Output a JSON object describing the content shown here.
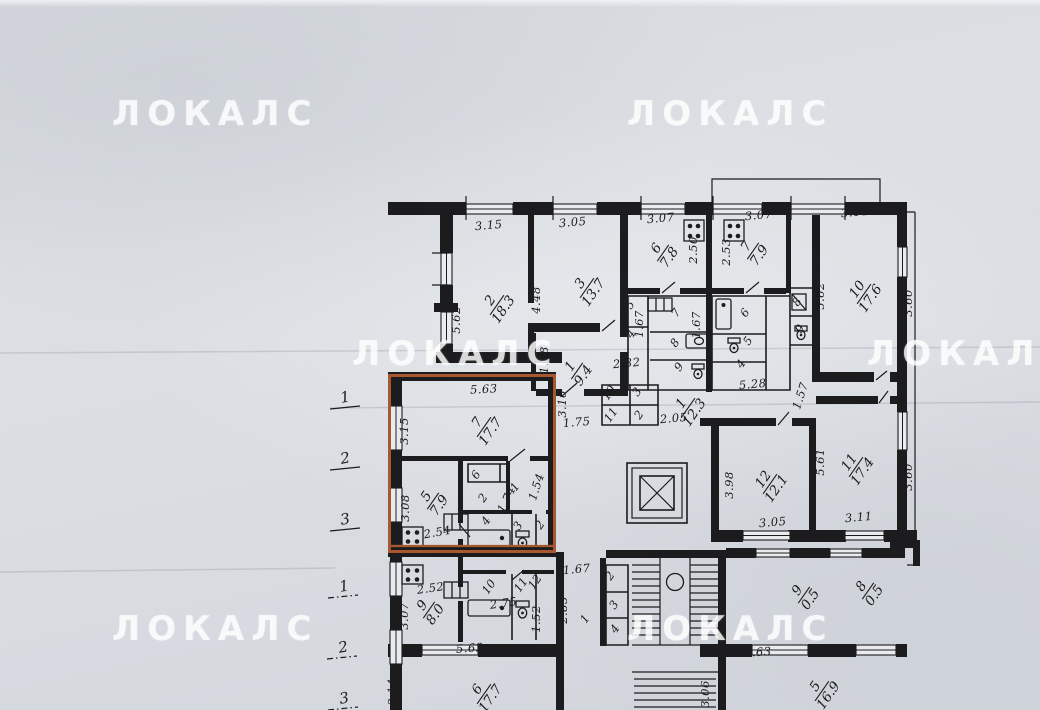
{
  "watermark": {
    "text": "ЛОКАЛС"
  },
  "highlight_color": "#a8572f",
  "axis_top": [
    "1",
    "2",
    "3"
  ],
  "axis_bottom": [
    "1",
    "2",
    "3"
  ],
  "rooms": [
    {
      "number": "2",
      "area": "18.3"
    },
    {
      "number": "3",
      "area": "13.7"
    },
    {
      "number": "6",
      "area": "7.8"
    },
    {
      "number": "7",
      "area": "7.9"
    },
    {
      "number": "10",
      "area": "17.6"
    },
    {
      "number": "1",
      "area": "9.4"
    },
    {
      "number": "1",
      "area": "12.3"
    },
    {
      "number": "12",
      "area": "12.1"
    },
    {
      "number": "11",
      "area": "17.4"
    },
    {
      "number": "7",
      "area": "17.7"
    },
    {
      "number": "5",
      "area": "7.9"
    },
    {
      "number": "9",
      "area": "8.0"
    },
    {
      "number": "9",
      "area": "0.5"
    },
    {
      "number": "8",
      "area": "0.5"
    },
    {
      "number": "6",
      "area": "17.7"
    },
    {
      "number": "5",
      "area": "16.9"
    }
  ],
  "small_rooms": [
    "7",
    "8",
    "9",
    "5",
    "4",
    "6",
    "5",
    "4",
    "8",
    "9",
    "10",
    "11",
    "3",
    "2",
    "6",
    "2",
    "1",
    "4",
    "3",
    "2",
    "10",
    "11",
    "12",
    "1",
    "2",
    "3",
    "4"
  ],
  "dims": [
    "3.15",
    "3.05",
    "3.07",
    "3.07",
    "3.14",
    "5.62",
    "4.48",
    "2.50",
    "2.53",
    "5.62",
    "3.60",
    "3.60",
    "1.08",
    "2.32",
    "1.67",
    "1.67",
    "3.16",
    "1.75",
    "2.05",
    "5.28",
    "1.57",
    "3.98",
    "3.05",
    "5.61",
    "3.11",
    "5.63",
    "3.15",
    "3.08",
    "2.54",
    "1.54",
    "1.74",
    "2.52",
    "3.07",
    "2.75",
    "1.52",
    "1.67",
    "2.83",
    "5.63",
    "5.63",
    "3.14",
    "3.06"
  ]
}
